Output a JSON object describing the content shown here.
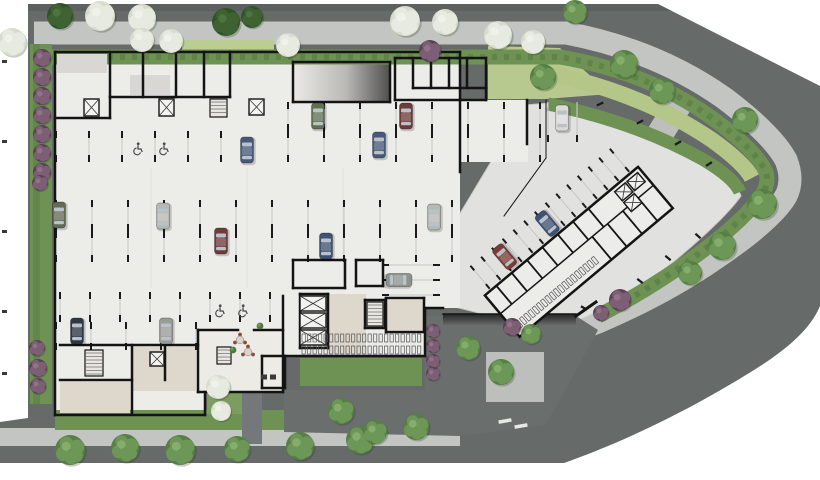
{
  "scene": {
    "width": 820,
    "height": 480,
    "title": "ground-floor-architectural-site-plan"
  },
  "palette": {
    "background": "#ffffff",
    "road": "#666a68",
    "road_dark": "#595d5b",
    "sidewalk": "#c2c5c1",
    "hedge": "#6e9254",
    "hedge_dark": "#567a42",
    "lawn": "#b4c688",
    "lawn_light": "#bccd92",
    "floor": "#ecece9",
    "plaza": "#e1e1df",
    "warm_floor": "#ddd7cc",
    "lobby_floor": "#edebe5",
    "roof_gray": "#d8d7d3",
    "wall": "#141414",
    "stall_line": "#c6c6c1",
    "tick": "#1a1a1a",
    "tree_pale_base": "#d7dccd",
    "tree_pale_lobe": "#e7eae0",
    "tree_green_base": "#567f45",
    "tree_green_lobe": "#6d9757",
    "tree_green_hi": "#87ad6d",
    "bush_dark": "#3f6233",
    "shrub_purple": "#5a4156",
    "shrub_purple_hi": "#7c5f74",
    "walkway_dark": "#75787a",
    "car_window": "#b8c2c8"
  },
  "landscape": {
    "trees_pale": [
      [
        12,
        42,
        14
      ],
      [
        100,
        16,
        15
      ],
      [
        142,
        18,
        14
      ],
      [
        142,
        40,
        12
      ],
      [
        171,
        41,
        12
      ],
      [
        288,
        45,
        12
      ],
      [
        405,
        21,
        15
      ],
      [
        445,
        22,
        13
      ],
      [
        498,
        35,
        14
      ],
      [
        533,
        42,
        12
      ],
      [
        218,
        387,
        12
      ],
      [
        221,
        411,
        10
      ]
    ],
    "trees_green": [
      [
        543,
        77,
        13
      ],
      [
        624,
        64,
        14
      ],
      [
        662,
        91,
        13
      ],
      [
        745,
        120,
        13
      ],
      [
        762,
        204,
        15
      ],
      [
        722,
        246,
        14
      ],
      [
        690,
        273,
        12
      ],
      [
        575,
        12,
        12
      ],
      [
        70,
        450,
        15
      ],
      [
        125,
        448,
        14
      ],
      [
        180,
        450,
        15
      ],
      [
        237,
        449,
        13
      ],
      [
        300,
        446,
        14
      ],
      [
        360,
        440,
        14
      ],
      [
        416,
        427,
        13
      ],
      [
        341,
        411,
        13
      ],
      [
        375,
        432,
        12
      ],
      [
        468,
        348,
        12
      ],
      [
        501,
        372,
        13
      ],
      [
        531,
        334,
        10
      ]
    ],
    "bushes": [
      [
        60,
        16,
        13
      ],
      [
        226,
        22,
        14
      ],
      [
        252,
        17,
        11
      ]
    ],
    "shrubs_purple": [
      [
        42,
        58,
        9
      ],
      [
        42,
        77,
        9
      ],
      [
        42,
        96,
        9
      ],
      [
        42,
        115,
        9
      ],
      [
        42,
        134,
        9
      ],
      [
        42,
        153,
        9
      ],
      [
        42,
        172,
        9
      ],
      [
        40,
        183,
        8
      ],
      [
        37,
        348,
        8
      ],
      [
        38,
        368,
        9
      ],
      [
        38,
        386,
        8
      ],
      [
        430,
        51,
        11
      ],
      [
        433,
        331,
        7
      ],
      [
        433,
        346,
        7
      ],
      [
        433,
        361,
        7
      ],
      [
        433,
        374,
        7
      ],
      [
        512,
        327,
        9
      ],
      [
        620,
        300,
        11
      ],
      [
        601,
        313,
        8
      ]
    ]
  },
  "building": {
    "walls": [
      [
        55,
        52,
        460,
        52
      ],
      [
        55,
        52,
        55,
        415
      ],
      [
        55,
        415,
        205,
        415
      ],
      [
        205,
        415,
        205,
        392
      ],
      [
        198,
        392,
        283,
        392
      ],
      [
        283,
        392,
        283,
        356
      ],
      [
        283,
        356,
        425,
        356
      ],
      [
        425,
        356,
        425,
        308
      ],
      [
        425,
        308,
        443,
        308
      ],
      [
        460,
        52,
        460,
        172
      ],
      [
        527,
        100,
        527,
        144
      ],
      [
        546,
        100,
        546,
        158,
        1
      ],
      [
        546,
        158,
        504,
        216,
        1
      ],
      [
        230,
        52,
        230,
        97
      ],
      [
        110,
        97,
        230,
        97
      ],
      [
        110,
        97,
        110,
        118
      ],
      [
        55,
        118,
        110,
        118
      ],
      [
        110,
        52,
        110,
        97
      ],
      [
        143,
        52,
        143,
        97
      ],
      [
        176,
        52,
        176,
        97
      ],
      [
        204,
        52,
        204,
        97
      ],
      [
        395,
        58,
        486,
        58
      ],
      [
        486,
        58,
        486,
        100
      ],
      [
        395,
        100,
        486,
        100
      ],
      [
        395,
        58,
        395,
        100
      ],
      [
        413,
        58,
        413,
        88
      ],
      [
        431,
        58,
        431,
        88
      ],
      [
        449,
        58,
        449,
        88
      ],
      [
        467,
        58,
        467,
        88
      ],
      [
        413,
        88,
        486,
        88
      ],
      [
        293,
        62,
        390,
        62
      ],
      [
        293,
        62,
        293,
        102
      ],
      [
        293,
        102,
        390,
        102
      ],
      [
        390,
        62,
        390,
        102
      ],
      [
        60,
        345,
        198,
        345
      ],
      [
        132,
        345,
        132,
        413
      ],
      [
        165,
        345,
        165,
        380
      ],
      [
        60,
        380,
        132,
        380
      ],
      [
        198,
        330,
        198,
        392
      ],
      [
        198,
        330,
        238,
        330
      ],
      [
        254,
        330,
        283,
        330
      ],
      [
        283,
        296,
        283,
        356
      ],
      [
        262,
        356,
        285,
        356
      ],
      [
        262,
        356,
        262,
        388
      ],
      [
        285,
        356,
        285,
        388
      ],
      [
        262,
        388,
        285,
        388
      ],
      [
        443,
        314,
        576,
        314,
        1.5
      ],
      [
        576,
        316,
        596,
        302,
        3
      ],
      [
        293,
        260,
        345,
        260
      ],
      [
        293,
        260,
        293,
        288
      ],
      [
        293,
        288,
        345,
        288
      ],
      [
        345,
        260,
        345,
        288
      ],
      [
        356,
        260,
        383,
        260
      ],
      [
        356,
        260,
        356,
        286
      ],
      [
        356,
        286,
        383,
        286
      ],
      [
        383,
        260,
        383,
        286
      ],
      [
        300,
        294,
        328,
        294
      ],
      [
        300,
        294,
        300,
        348
      ],
      [
        328,
        294,
        328,
        348
      ],
      [
        300,
        348,
        328,
        348
      ],
      [
        365,
        300,
        385,
        300
      ],
      [
        365,
        300,
        365,
        328
      ],
      [
        385,
        300,
        385,
        328
      ],
      [
        365,
        328,
        385,
        328
      ],
      [
        386,
        298,
        424,
        298
      ],
      [
        424,
        298,
        424,
        332
      ],
      [
        386,
        332,
        424,
        332
      ],
      [
        386,
        298,
        386,
        332
      ]
    ],
    "fills": [
      [
        57,
        54,
        50,
        19,
        "roof_gray"
      ],
      [
        130,
        75,
        40,
        20,
        "roof_gray"
      ],
      [
        328,
        294,
        38,
        60,
        "warm_floor"
      ],
      [
        132,
        347,
        64,
        44,
        "warm_floor"
      ],
      [
        60,
        382,
        70,
        31,
        "warm_floor"
      ],
      [
        198,
        330,
        85,
        62,
        "lobby_floor"
      ],
      [
        386,
        300,
        38,
        30,
        "warm_floor"
      ]
    ],
    "cores": [
      [
        84,
        99,
        15,
        17
      ],
      [
        159,
        99,
        15,
        17
      ],
      [
        249,
        99,
        15,
        16
      ],
      [
        300,
        296,
        26,
        15
      ],
      [
        300,
        313,
        26,
        15
      ],
      [
        300,
        330,
        26,
        15
      ],
      [
        150,
        352,
        14,
        14
      ]
    ],
    "stairs": [
      [
        210,
        99,
        17,
        18
      ],
      [
        367,
        302,
        16,
        24
      ],
      [
        85,
        350,
        18,
        26
      ],
      [
        217,
        347,
        14,
        17
      ]
    ],
    "bike_rows": [
      [
        302,
        420,
        334,
        8
      ],
      [
        302,
        420,
        346,
        8
      ]
    ],
    "faint_lines": [
      [
        151,
        168,
        151,
        288
      ],
      [
        247,
        168,
        247,
        288
      ],
      [
        343,
        168,
        343,
        288
      ]
    ]
  },
  "wing": {
    "angle": -40,
    "cx": 575,
    "cy": 255,
    "rect": [
      480,
      228,
      200,
      54
    ],
    "partitions": [
      [
        495,
        228,
        495,
        252
      ],
      [
        515,
        228,
        515,
        252
      ],
      [
        535,
        228,
        535,
        252
      ],
      [
        555,
        228,
        555,
        252
      ],
      [
        575,
        228,
        575,
        252
      ],
      [
        595,
        228,
        595,
        252
      ],
      [
        615,
        228,
        615,
        252
      ],
      [
        480,
        252,
        680,
        252,
        1.5
      ],
      [
        600,
        252,
        600,
        282
      ],
      [
        620,
        252,
        620,
        282
      ],
      [
        640,
        252,
        640,
        282
      ],
      [
        660,
        252,
        660,
        282
      ]
    ],
    "cores": [
      [
        646,
        232,
        14,
        12
      ],
      [
        662,
        232,
        14,
        12
      ],
      [
        646,
        246,
        14,
        12
      ]
    ],
    "bike_row": [
      486,
      588,
      268,
      8
    ],
    "stalls": {
      "x0": 488,
      "x1": 672,
      "step": 14,
      "y0": 196,
      "y1": 226
    },
    "cars": [
      [
        520,
        211,
        "#7a3b36"
      ],
      [
        574,
        213,
        "#3f5273"
      ]
    ]
  },
  "parking": {
    "rows": [
      {
        "x0": 288,
        "x1": 540,
        "step": 36,
        "y0": 102,
        "y1": 131
      },
      {
        "x0": 56,
        "x1": 252,
        "step": 33,
        "y0": 131,
        "y1": 162
      },
      {
        "x0": 288,
        "x1": 540,
        "step": 36,
        "y0": 131,
        "y1": 162
      },
      {
        "x0": 56,
        "x1": 456,
        "step": 36,
        "y0": 200,
        "y1": 231
      },
      {
        "x0": 56,
        "x1": 456,
        "step": 36,
        "y0": 231,
        "y1": 262
      },
      {
        "x0": 60,
        "x1": 270,
        "step": 30,
        "y0": 292,
        "y1": 322
      },
      {
        "x0": 56,
        "x1": 198,
        "step": 35,
        "y0": 322,
        "y1": 350
      }
    ],
    "h_row": {
      "x0": 382,
      "x1": 440,
      "ys": [
        265,
        280,
        295
      ]
    },
    "accessible": [
      [
        137,
        148
      ],
      [
        163,
        148
      ],
      [
        219,
        310
      ],
      [
        242,
        310
      ]
    ],
    "visitor_stall": [
      [
        548,
        102,
        548,
        142
      ],
      [
        577,
        102,
        577,
        142
      ]
    ],
    "curb_dashes": [
      [
        600,
        104,
        -25
      ],
      [
        640,
        122,
        -27
      ],
      [
        678,
        143,
        -30
      ],
      [
        709,
        164,
        -33
      ],
      [
        668,
        258,
        40
      ],
      [
        698,
        236,
        42
      ],
      [
        640,
        281,
        38
      ],
      [
        584,
        308,
        30
      ]
    ]
  },
  "vehicles": [
    [
      318,
      116,
      "#5e7152",
      0
    ],
    [
      406,
      116,
      "#6e3b3b",
      0
    ],
    [
      379,
      145,
      "#47597a",
      0
    ],
    [
      562,
      118,
      "#d9dad6",
      0
    ],
    [
      247,
      150,
      "#47597a",
      0
    ],
    [
      59,
      215,
      "#626b54",
      0
    ],
    [
      163,
      216,
      "#b6b8b4",
      0
    ],
    [
      221,
      241,
      "#6e3b3b",
      0
    ],
    [
      326,
      246,
      "#3f5273",
      0
    ],
    [
      434,
      217,
      "#b6b8b4",
      0
    ],
    [
      399,
      280,
      "#8f918d",
      90
    ],
    [
      77,
      331,
      "#2f3744",
      0
    ],
    [
      166,
      331,
      "#9a9c98",
      0
    ]
  ],
  "amenities": {
    "tables": [
      [
        240,
        340
      ],
      [
        248,
        352
      ]
    ],
    "plants": [
      [
        233,
        350
      ],
      [
        260,
        326
      ]
    ],
    "benches": [
      [
        264,
        377
      ],
      [
        273,
        377
      ]
    ]
  },
  "markings": {
    "property_ticks": [
      [
        2,
        60
      ],
      [
        2,
        140
      ],
      [
        2,
        230
      ],
      [
        2,
        310
      ],
      [
        2,
        372
      ]
    ],
    "crosswalk_bars": [
      [
        505,
        421,
        -10
      ],
      [
        521,
        426,
        -10
      ]
    ]
  }
}
